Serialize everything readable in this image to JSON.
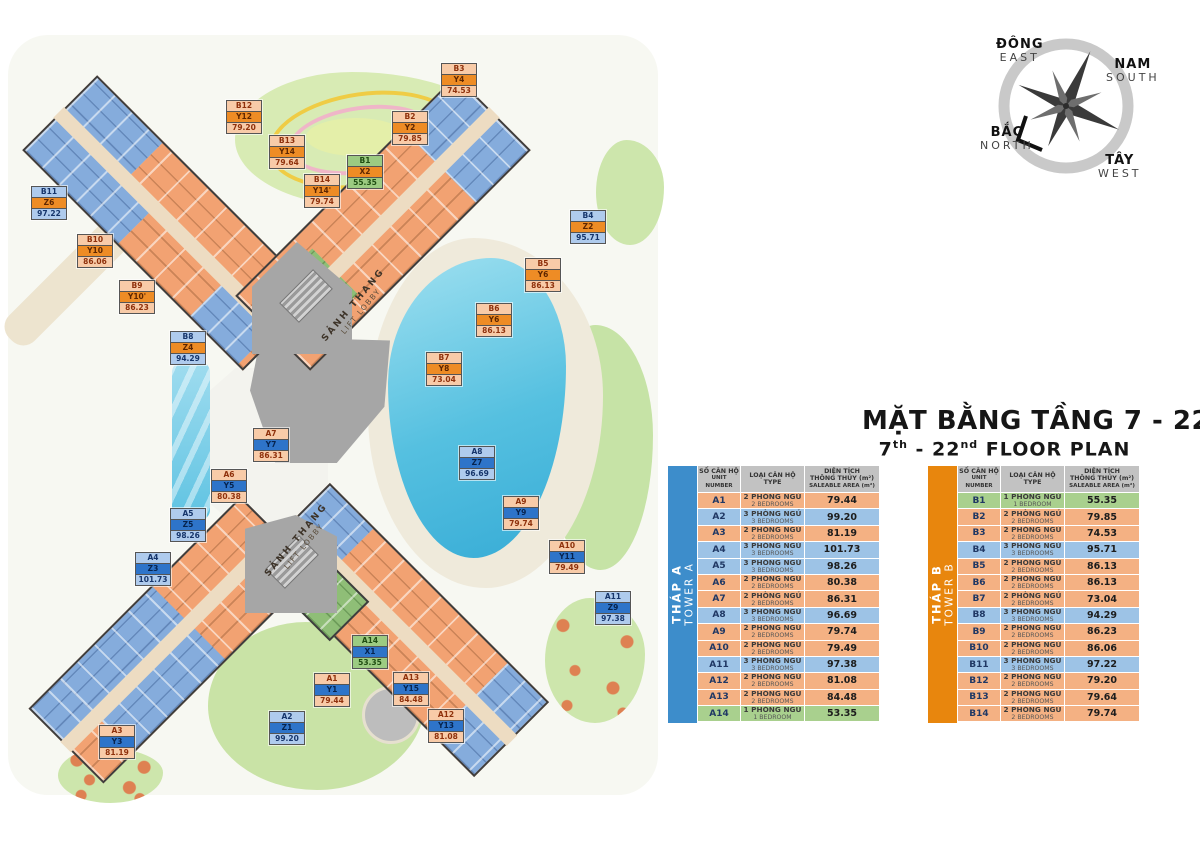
{
  "title": {
    "vi": "MẶT BẰNG TẦNG 7 - 22",
    "en": {
      "p1": "7",
      "s1": "th",
      "p2": " - 22",
      "s2": "nd",
      "p3": " FLOOR PLAN"
    }
  },
  "compass": {
    "east_vi": "ĐÔNG",
    "east_en": "EAST",
    "south_vi": "NAM",
    "south_en": "SOUTH",
    "north_vi": "BẮC",
    "north_en": "NORTH",
    "west_vi": "TÂY",
    "west_en": "WEST"
  },
  "plan": {
    "lift_lobby_vi": "SẢNH THANG",
    "lift_lobby_en": "LIFT LOBBY",
    "labels": [
      {
        "unit": "B3",
        "code": "Y4",
        "area": "74.53",
        "br": 2,
        "tower": "b",
        "x": 459,
        "y": 80
      },
      {
        "unit": "B12",
        "code": "Y12",
        "area": "79.20",
        "br": 2,
        "tower": "b",
        "x": 244,
        "y": 117
      },
      {
        "unit": "B2",
        "code": "Y2",
        "area": "79.85",
        "br": 2,
        "tower": "b",
        "x": 410,
        "y": 128
      },
      {
        "unit": "B13",
        "code": "Y14",
        "area": "79.64",
        "br": 2,
        "tower": "b",
        "x": 287,
        "y": 152
      },
      {
        "unit": "B1",
        "code": "X2",
        "area": "55.35",
        "br": 1,
        "tower": "b",
        "x": 365,
        "y": 172
      },
      {
        "unit": "B14",
        "code": "Y14'",
        "area": "79.74",
        "br": 2,
        "tower": "b",
        "x": 322,
        "y": 191
      },
      {
        "unit": "B11",
        "code": "Z6",
        "area": "97.22",
        "br": 3,
        "tower": "b",
        "x": 49,
        "y": 203
      },
      {
        "unit": "B4",
        "code": "Z2",
        "area": "95.71",
        "br": 3,
        "tower": "b",
        "x": 588,
        "y": 227
      },
      {
        "unit": "B10",
        "code": "Y10",
        "area": "86.06",
        "br": 2,
        "tower": "b",
        "x": 95,
        "y": 251
      },
      {
        "unit": "B5",
        "code": "Y6",
        "area": "86.13",
        "br": 2,
        "tower": "b",
        "x": 543,
        "y": 275
      },
      {
        "unit": "B9",
        "code": "Y10'",
        "area": "86.23",
        "br": 2,
        "tower": "b",
        "x": 137,
        "y": 297
      },
      {
        "unit": "B6",
        "code": "Y6",
        "area": "86.13",
        "br": 2,
        "tower": "b",
        "x": 494,
        "y": 320
      },
      {
        "unit": "B8",
        "code": "Z4",
        "area": "94.29",
        "br": 3,
        "tower": "b",
        "x": 188,
        "y": 348
      },
      {
        "unit": "B7",
        "code": "Y8",
        "area": "73.04",
        "br": 2,
        "tower": "b",
        "x": 444,
        "y": 369
      },
      {
        "unit": "A7",
        "code": "Y7",
        "area": "86.31",
        "br": 2,
        "tower": "a",
        "x": 271,
        "y": 445
      },
      {
        "unit": "A8",
        "code": "Z7",
        "area": "96.69",
        "br": 3,
        "tower": "a",
        "x": 477,
        "y": 463
      },
      {
        "unit": "A6",
        "code": "Y5",
        "area": "80.38",
        "br": 2,
        "tower": "a",
        "x": 229,
        "y": 486
      },
      {
        "unit": "A9",
        "code": "Y9",
        "area": "79.74",
        "br": 2,
        "tower": "a",
        "x": 521,
        "y": 513
      },
      {
        "unit": "A5",
        "code": "Z5",
        "area": "98.26",
        "br": 3,
        "tower": "a",
        "x": 188,
        "y": 525
      },
      {
        "unit": "A10",
        "code": "Y11",
        "area": "79.49",
        "br": 2,
        "tower": "a",
        "x": 567,
        "y": 557
      },
      {
        "unit": "A4",
        "code": "Z3",
        "area": "101.73",
        "br": 3,
        "tower": "a",
        "x": 153,
        "y": 569
      },
      {
        "unit": "A11",
        "code": "Z9",
        "area": "97.38",
        "br": 3,
        "tower": "a",
        "x": 613,
        "y": 608
      },
      {
        "unit": "A14",
        "code": "X1",
        "area": "53.35",
        "br": 1,
        "tower": "a",
        "x": 370,
        "y": 652
      },
      {
        "unit": "A1",
        "code": "Y1",
        "area": "79.44",
        "br": 2,
        "tower": "a",
        "x": 332,
        "y": 690
      },
      {
        "unit": "A13",
        "code": "Y15",
        "area": "84.48",
        "br": 2,
        "tower": "a",
        "x": 411,
        "y": 689
      },
      {
        "unit": "A2",
        "code": "Z1",
        "area": "99.20",
        "br": 3,
        "tower": "a",
        "x": 287,
        "y": 728
      },
      {
        "unit": "A12",
        "code": "Y13",
        "area": "81.08",
        "br": 2,
        "tower": "a",
        "x": 446,
        "y": 726
      },
      {
        "unit": "A3",
        "code": "Y3",
        "area": "81.19",
        "br": 2,
        "tower": "a",
        "x": 117,
        "y": 742
      }
    ]
  },
  "tables": [
    {
      "id": "a",
      "side_line1": "THÁP A",
      "side_line2": "TOWER A",
      "accent": "#3D8DCB",
      "header": {
        "c1": [
          "SỐ CĂN HỘ",
          "UNIT",
          "NUMBER"
        ],
        "c2": [
          "LOẠI CĂN HỘ",
          "TYPE"
        ],
        "c3": [
          "DIỆN TÍCH",
          "THÔNG THỦY (m²)",
          "SALEABLE AREA (m²)"
        ]
      },
      "rows": [
        {
          "unit": "A1",
          "type_vi": "2 PHÒNG NGỦ",
          "type_en": "2 BEDROOMS",
          "area": "79.44",
          "br": 2
        },
        {
          "unit": "A2",
          "type_vi": "3 PHÒNG NGỦ",
          "type_en": "3 BEDROOMS",
          "area": "99.20",
          "br": 3
        },
        {
          "unit": "A3",
          "type_vi": "2 PHÒNG NGỦ",
          "type_en": "2 BEDROOMS",
          "area": "81.19",
          "br": 2
        },
        {
          "unit": "A4",
          "type_vi": "3 PHÒNG NGỦ",
          "type_en": "3 BEDROOMS",
          "area": "101.73",
          "br": 3
        },
        {
          "unit": "A5",
          "type_vi": "3 PHÒNG NGỦ",
          "type_en": "3 BEDROOMS",
          "area": "98.26",
          "br": 3
        },
        {
          "unit": "A6",
          "type_vi": "2 PHÒNG NGỦ",
          "type_en": "2 BEDROOMS",
          "area": "80.38",
          "br": 2
        },
        {
          "unit": "A7",
          "type_vi": "2 PHÒNG NGỦ",
          "type_en": "2 BEDROOMS",
          "area": "86.31",
          "br": 2
        },
        {
          "unit": "A8",
          "type_vi": "3 PHÒNG NGỦ",
          "type_en": "3 BEDROOMS",
          "area": "96.69",
          "br": 3
        },
        {
          "unit": "A9",
          "type_vi": "2 PHÒNG NGỦ",
          "type_en": "2 BEDROOMS",
          "area": "79.74",
          "br": 2
        },
        {
          "unit": "A10",
          "type_vi": "2 PHÒNG NGỦ",
          "type_en": "2 BEDROOMS",
          "area": "79.49",
          "br": 2
        },
        {
          "unit": "A11",
          "type_vi": "3 PHÒNG NGỦ",
          "type_en": "3 BEDROOMS",
          "area": "97.38",
          "br": 3
        },
        {
          "unit": "A12",
          "type_vi": "2 PHÒNG NGỦ",
          "type_en": "2 BEDROOMS",
          "area": "81.08",
          "br": 2
        },
        {
          "unit": "A13",
          "type_vi": "2 PHÒNG NGỦ",
          "type_en": "2 BEDROOMS",
          "area": "84.48",
          "br": 2
        },
        {
          "unit": "A14",
          "type_vi": "1 PHÒNG NGỦ",
          "type_en": "1 BEDROOM",
          "area": "53.35",
          "br": 1
        }
      ]
    },
    {
      "id": "b",
      "side_line1": "THÁP B",
      "side_line2": "TOWER B",
      "accent": "#E8860D",
      "header": {
        "c1": [
          "SỐ CĂN HỘ",
          "UNIT",
          "NUMBER"
        ],
        "c2": [
          "LOẠI CĂN HỘ",
          "TYPE"
        ],
        "c3": [
          "DIỆN TÍCH",
          "THÔNG THỦY (m²)",
          "SALEABLE AREA (m²)"
        ]
      },
      "rows": [
        {
          "unit": "B1",
          "type_vi": "1 PHÒNG NGỦ",
          "type_en": "1 BEDROOM",
          "area": "55.35",
          "br": 1
        },
        {
          "unit": "B2",
          "type_vi": "2 PHÒNG NGỦ",
          "type_en": "2 BEDROOMS",
          "area": "79.85",
          "br": 2
        },
        {
          "unit": "B3",
          "type_vi": "2 PHÒNG NGỦ",
          "type_en": "2 BEDROOMS",
          "area": "74.53",
          "br": 2
        },
        {
          "unit": "B4",
          "type_vi": "3 PHÒNG NGỦ",
          "type_en": "3 BEDROOMS",
          "area": "95.71",
          "br": 3
        },
        {
          "unit": "B5",
          "type_vi": "2 PHÒNG NGỦ",
          "type_en": "2 BEDROOMS",
          "area": "86.13",
          "br": 2
        },
        {
          "unit": "B6",
          "type_vi": "2 PHÒNG NGỦ",
          "type_en": "2 BEDROOMS",
          "area": "86.13",
          "br": 2
        },
        {
          "unit": "B7",
          "type_vi": "2 PHÒNG NGỦ",
          "type_en": "2 BEDROOMS",
          "area": "73.04",
          "br": 2
        },
        {
          "unit": "B8",
          "type_vi": "3 PHÒNG NGỦ",
          "type_en": "3 BEDROOMS",
          "area": "94.29",
          "br": 3
        },
        {
          "unit": "B9",
          "type_vi": "2 PHÒNG NGỦ",
          "type_en": "2 BEDROOMS",
          "area": "86.23",
          "br": 2
        },
        {
          "unit": "B10",
          "type_vi": "2 PHÒNG NGỦ",
          "type_en": "2 BEDROOMS",
          "area": "86.06",
          "br": 2
        },
        {
          "unit": "B11",
          "type_vi": "3 PHÒNG NGỦ",
          "type_en": "3 BEDROOMS",
          "area": "97.22",
          "br": 3
        },
        {
          "unit": "B12",
          "type_vi": "2 PHÒNG NGỦ",
          "type_en": "2 BEDROOMS",
          "area": "79.20",
          "br": 2
        },
        {
          "unit": "B13",
          "type_vi": "2 PHÒNG NGỦ",
          "type_en": "2 BEDROOMS",
          "area": "79.64",
          "br": 2
        },
        {
          "unit": "B14",
          "type_vi": "2 PHÒNG NGỦ",
          "type_en": "2 BEDROOMS",
          "area": "79.74",
          "br": 2
        }
      ]
    }
  ],
  "colors": {
    "br1": "#A9D08E",
    "br2": "#F4B183",
    "br3": "#9DC3E6",
    "towerA": "#3D8DCB",
    "towerB": "#E8860D"
  }
}
